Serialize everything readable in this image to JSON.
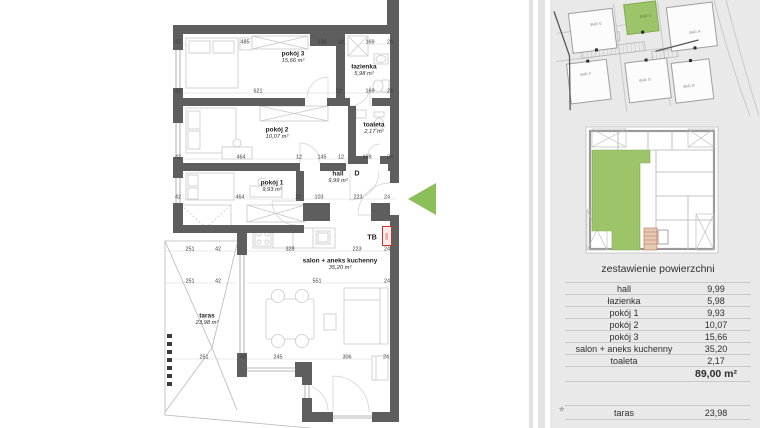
{
  "colors": {
    "wall_gray": "#5e5e5e",
    "highlight_green": "#9cc468",
    "arrow_green": "#8cbe5a",
    "accent_red": "#cc3322",
    "stairs_tan": "#e2cbb2",
    "panel_bg": "#e9e9e9"
  },
  "floor_plan": {
    "rooms": [
      {
        "name": "pokój 3",
        "area": "15,66 m²",
        "x": 293,
        "y": 57
      },
      {
        "name": "łazienka",
        "area": "5,98 m²",
        "x": 364,
        "y": 70
      },
      {
        "name": "pokój 2",
        "area": "10,07 m²",
        "x": 277,
        "y": 133
      },
      {
        "name": "toaleta",
        "area": "2,17 m²",
        "x": 374,
        "y": 128
      },
      {
        "name": "pokój 1",
        "area": "9,93 m²",
        "x": 272,
        "y": 186
      },
      {
        "name": "hall",
        "area": "9,99 m²",
        "x": 338,
        "y": 177
      },
      {
        "name": "salon + aneks kuchenny",
        "area": "35,20 m²",
        "x": 340,
        "y": 264
      },
      {
        "name": "taras",
        "area": "23,98 m²",
        "x": 207,
        "y": 319
      }
    ],
    "markers": {
      "entrance_door": "D",
      "switchboard": "TB",
      "meter_box": "eco"
    },
    "dim_labels": [
      {
        "t": "42",
        "x": 178,
        "y": 42
      },
      {
        "t": "485",
        "x": 245,
        "y": 42
      },
      {
        "t": "136",
        "x": 322,
        "y": 42
      },
      {
        "t": "12",
        "x": 341,
        "y": 42
      },
      {
        "t": "169",
        "x": 370,
        "y": 42
      },
      {
        "t": "24",
        "x": 390,
        "y": 42
      },
      {
        "t": "42",
        "x": 178,
        "y": 91
      },
      {
        "t": "621",
        "x": 258,
        "y": 91
      },
      {
        "t": "12",
        "x": 339,
        "y": 91
      },
      {
        "t": "169",
        "x": 370,
        "y": 91
      },
      {
        "t": "24",
        "x": 390,
        "y": 91
      },
      {
        "t": "42",
        "x": 178,
        "y": 157
      },
      {
        "t": "464",
        "x": 241,
        "y": 157
      },
      {
        "t": "12",
        "x": 299,
        "y": 157
      },
      {
        "t": "145",
        "x": 322,
        "y": 157
      },
      {
        "t": "12",
        "x": 341,
        "y": 157
      },
      {
        "t": "169",
        "x": 367,
        "y": 157
      },
      {
        "t": "24",
        "x": 390,
        "y": 157
      },
      {
        "t": "42",
        "x": 178,
        "y": 197
      },
      {
        "t": "464",
        "x": 240,
        "y": 197
      },
      {
        "t": "12",
        "x": 298,
        "y": 197
      },
      {
        "t": "103",
        "x": 319,
        "y": 197
      },
      {
        "t": "223",
        "x": 358,
        "y": 197
      },
      {
        "t": "24",
        "x": 387,
        "y": 197
      },
      {
        "t": "251",
        "x": 190,
        "y": 249
      },
      {
        "t": "42",
        "x": 218,
        "y": 249
      },
      {
        "t": "328",
        "x": 290,
        "y": 249
      },
      {
        "t": "223",
        "x": 357,
        "y": 249
      },
      {
        "t": "24",
        "x": 387,
        "y": 249
      },
      {
        "t": "251",
        "x": 190,
        "y": 281
      },
      {
        "t": "42",
        "x": 218,
        "y": 281
      },
      {
        "t": "551",
        "x": 317,
        "y": 281
      },
      {
        "t": "24",
        "x": 387,
        "y": 281
      },
      {
        "t": "251",
        "x": 204,
        "y": 357
      },
      {
        "t": "42",
        "x": 243,
        "y": 357
      },
      {
        "t": "245",
        "x": 278,
        "y": 357
      },
      {
        "t": "306",
        "x": 347,
        "y": 357
      },
      {
        "t": "24",
        "x": 386,
        "y": 357
      }
    ]
  },
  "site_plan": {
    "buildings": [
      {
        "label": "BUD. E",
        "x": 596,
        "y": 24
      },
      {
        "label": "BUD. C",
        "x": 646,
        "y": 16,
        "green": true
      },
      {
        "label": "BUD. A",
        "x": 695,
        "y": 32
      },
      {
        "label": "BUD. F",
        "x": 586,
        "y": 74
      },
      {
        "label": "BUD. D",
        "x": 645,
        "y": 80
      },
      {
        "label": "BUD. B",
        "x": 689,
        "y": 86
      }
    ]
  },
  "panel": {
    "table": {
      "title": "zestawienie powierzchni",
      "rows": [
        {
          "label": "hall",
          "value": "9,99"
        },
        {
          "label": "łazienka",
          "value": "5,98"
        },
        {
          "label": "pokój 1",
          "value": "9,93"
        },
        {
          "label": "pokój 2",
          "value": "10,07"
        },
        {
          "label": "pokój 3",
          "value": "15,66"
        },
        {
          "label": "salon + aneks kuchenny",
          "value": "35,20"
        },
        {
          "label": "toaleta",
          "value": "2,17"
        }
      ],
      "total": "89,00 m²",
      "taras_row": {
        "label": "taras",
        "value": "23,98"
      },
      "footnote_marker": "*"
    }
  }
}
